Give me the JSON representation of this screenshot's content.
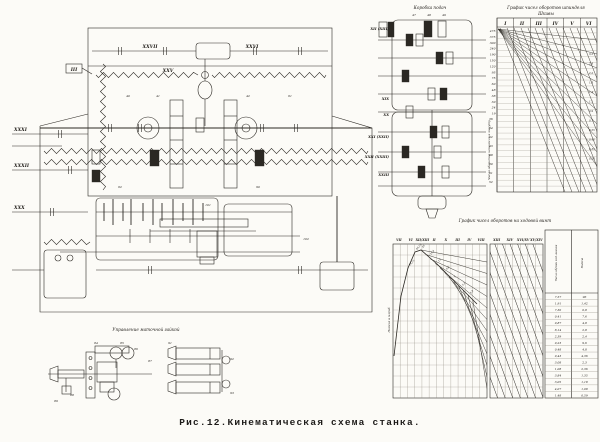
{
  "figure": {
    "caption": "Рис.12.Кинематическая схема станка.",
    "paper_color": "#fcfbf7",
    "ink_color": "#2b2823"
  },
  "main_diagram": {
    "top_shaft_labels": [
      "XXVII",
      "XXVI"
    ],
    "upper_spring_label": "XXV",
    "inner_label": "III",
    "left_shaft_labels": [
      "XXXI",
      "XXXII",
      "XXX"
    ],
    "callouts": [
      "40",
      "41",
      "42",
      "61",
      "62",
      "90",
      "101",
      "102"
    ]
  },
  "feed_box": {
    "title": "Коробка подач",
    "top_numbers": [
      "47",
      "48",
      "49"
    ],
    "shaft_labels": [
      "XII (XIII)",
      "XIX",
      "XX",
      "XXI (XXII)",
      "XXII (XXIII)",
      "XXIII"
    ],
    "right_numbers": [
      "36",
      "34",
      "52",
      "43",
      "48",
      "50",
      "51",
      "52"
    ]
  },
  "speed_chart": {
    "title": "График чисел оборотов шпинделя",
    "subtitle": "Шкивы",
    "columns": [
      "I",
      "II",
      "III",
      "IV",
      "V",
      "VI"
    ],
    "axis_values": [
      "475",
      "375",
      "300",
      "240",
      "190",
      "150",
      "120",
      "95",
      "75",
      "60",
      "48",
      "38",
      "30",
      "24",
      "19"
    ],
    "axis_label": "Числа оборотов шпинделя в минуту",
    "ray_labels": [
      "3,5",
      "2,8",
      "2,2",
      "1,8",
      "1,4",
      "1,1",
      "0,9",
      "0,7",
      "0,55",
      "0,45",
      "0,35",
      "0,28"
    ]
  },
  "feed_chart": {
    "title": "График чисел оборотов на ходовой винт",
    "left_columns": [
      "VII",
      "VI",
      "XII/XIII",
      "II",
      "X",
      "III",
      "IV",
      "VIII"
    ],
    "right_columns": [
      "XIII",
      "XIV",
      "XVI/XV",
      "XV/XIV"
    ],
    "axis_label": "Подача в мм/об",
    "curve_labels": [
      "78,15",
      "44,18",
      "26",
      "18,4",
      "13",
      "9,6",
      "7",
      "5,2",
      "3,8"
    ],
    "curve_points": [
      [
        394,
        356
      ],
      [
        401,
        296
      ],
      [
        408,
        268
      ],
      [
        415,
        252
      ],
      [
        421,
        250
      ],
      [
        429,
        257
      ],
      [
        437,
        264
      ],
      [
        445,
        272
      ],
      [
        453,
        280
      ],
      [
        461,
        288
      ],
      [
        469,
        296
      ],
      [
        477,
        304
      ]
    ],
    "table": {
      "col1_header": "Число об/мин ход. валика",
      "col2_header": "Подача",
      "rows": [
        [
          "7,57",
          "96"
        ],
        [
          "1,91",
          "1,42"
        ],
        [
          "7,30",
          "0,8"
        ],
        [
          "0,41",
          "7,6"
        ],
        [
          "0,87",
          "4,8"
        ],
        [
          "8,14",
          "2,8"
        ],
        [
          "2,39",
          "2,4"
        ],
        [
          "0,23",
          "9,6"
        ],
        [
          "0,48",
          "4,8"
        ],
        [
          "0,43",
          "4,36"
        ],
        [
          "3,08",
          "2,3"
        ],
        [
          "1,08",
          "2,36"
        ],
        [
          "3,84",
          "1,35"
        ],
        [
          "3,05",
          "1,18"
        ],
        [
          "4,07",
          "1,08"
        ],
        [
          "1,48",
          "0,59"
        ]
      ]
    }
  },
  "detail_diagram": {
    "title": "Управление маточной гайкой",
    "callouts": [
      "84",
      "85",
      "86",
      "87",
      "88",
      "89",
      "91",
      "92",
      "93"
    ]
  }
}
